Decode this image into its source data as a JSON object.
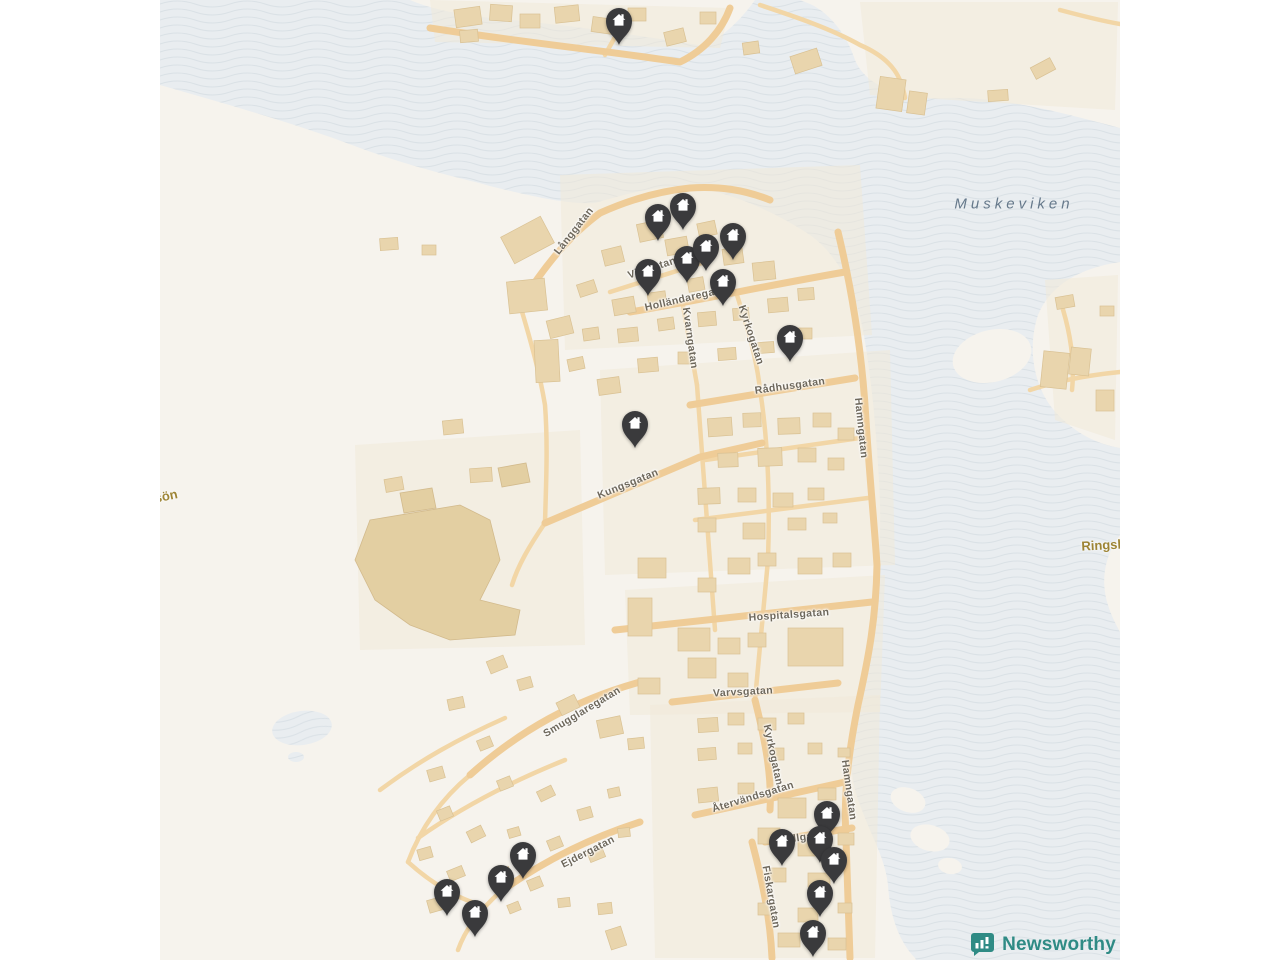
{
  "attribution": {
    "brand": "Newsworthy"
  },
  "map": {
    "water_label": {
      "text": "Muskeviken",
      "x": 1014,
      "y": 204
    },
    "island_labels": [
      {
        "text": "sön",
        "x": 166,
        "y": 496,
        "rot": -12
      },
      {
        "text": "Ringsk",
        "x": 1103,
        "y": 545,
        "rot": -3
      }
    ],
    "street_labels": [
      {
        "text": "Långgatan",
        "x": 574,
        "y": 231,
        "rot": -52
      },
      {
        "text": "Vilagatan",
        "x": 652,
        "y": 268,
        "rot": -18
      },
      {
        "text": "Holländaregatan",
        "x": 688,
        "y": 298,
        "rot": -13
      },
      {
        "text": "Kvarngatan",
        "x": 690,
        "y": 338,
        "rot": 82
      },
      {
        "text": "Kyrkogatan",
        "x": 751,
        "y": 335,
        "rot": 72
      },
      {
        "text": "Rådhusgatan",
        "x": 790,
        "y": 386,
        "rot": -8
      },
      {
        "text": "Hamngatan",
        "x": 861,
        "y": 428,
        "rot": 84
      },
      {
        "text": "Kungsgatan",
        "x": 628,
        "y": 484,
        "rot": -22
      },
      {
        "text": "Hospitalsgatan",
        "x": 789,
        "y": 615,
        "rot": -4
      },
      {
        "text": "Varvsgatan",
        "x": 743,
        "y": 692,
        "rot": -3
      },
      {
        "text": "Smugglaregatan",
        "x": 582,
        "y": 712,
        "rot": -31
      },
      {
        "text": "Kyrkogatan",
        "x": 773,
        "y": 755,
        "rot": 78
      },
      {
        "text": "Återvändsgatan",
        "x": 753,
        "y": 797,
        "rot": -17
      },
      {
        "text": "Hamngatan",
        "x": 849,
        "y": 790,
        "rot": 82
      },
      {
        "text": "Sillgatan",
        "x": 806,
        "y": 837,
        "rot": -8
      },
      {
        "text": "Fiskargatan",
        "x": 771,
        "y": 897,
        "rot": 80
      },
      {
        "text": "Ejdergatan",
        "x": 588,
        "y": 852,
        "rot": -27
      }
    ],
    "markers": [
      {
        "x": 619,
        "y": 20
      },
      {
        "x": 658,
        "y": 216
      },
      {
        "x": 683,
        "y": 205
      },
      {
        "x": 648,
        "y": 271
      },
      {
        "x": 687,
        "y": 258
      },
      {
        "x": 706,
        "y": 246
      },
      {
        "x": 733,
        "y": 235
      },
      {
        "x": 723,
        "y": 281
      },
      {
        "x": 790,
        "y": 337
      },
      {
        "x": 635,
        "y": 423
      },
      {
        "x": 827,
        "y": 813
      },
      {
        "x": 820,
        "y": 838
      },
      {
        "x": 782,
        "y": 841
      },
      {
        "x": 834,
        "y": 859
      },
      {
        "x": 820,
        "y": 892
      },
      {
        "x": 813,
        "y": 932
      },
      {
        "x": 523,
        "y": 854
      },
      {
        "x": 501,
        "y": 877
      },
      {
        "x": 447,
        "y": 891
      },
      {
        "x": 475,
        "y": 912
      }
    ],
    "marker_icon": "house",
    "colors": {
      "water": "#e9edf0",
      "wave_line": "#dae1e6",
      "land": "#f6f3ed",
      "district": "#f1e9d8",
      "road": "#efcc97",
      "road_minor": "#f2d6a6",
      "building": "#e9d5ad",
      "marker": "#3a3a3c",
      "brand": "#2f8b85",
      "street_label": "#6e685c",
      "island_label": "#9d8434"
    }
  }
}
